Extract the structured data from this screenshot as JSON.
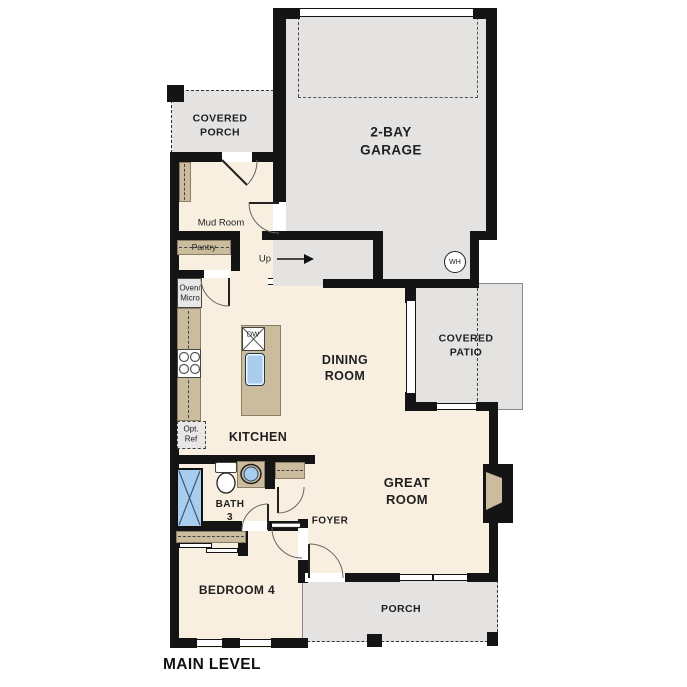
{
  "plan": {
    "title": "MAIN LEVEL"
  },
  "colors": {
    "wall": "#141414",
    "exterior_gray": "#e4e3e1",
    "interior_cream": "#f8efe1",
    "casework_tan": "#cbbc9e",
    "fixture_blue": "#a9cdec"
  },
  "rooms": {
    "garage": {
      "line1": "2-BAY",
      "line2": "GARAGE"
    },
    "covered_porch": {
      "line1": "COVERED",
      "line2": "PORCH"
    },
    "covered_patio": {
      "line1": "COVERED",
      "line2": "PATIO"
    },
    "dining": {
      "line1": "DINING",
      "line2": "ROOM"
    },
    "great_room": {
      "line1": "GREAT",
      "line2": "ROOM"
    },
    "bath3": {
      "line1": "BATH",
      "line2": "3"
    },
    "mud_room": {
      "label": "Mud Room"
    },
    "pantry": {
      "label": "Pantry"
    },
    "kitchen": {
      "label": "KITCHEN"
    },
    "foyer": {
      "label": "FOYER"
    },
    "bedroom4": {
      "label": "BEDROOM 4"
    },
    "porch": {
      "label": "PORCH"
    }
  },
  "annotations": {
    "up": "Up",
    "water_heater": "WH",
    "dishwasher": "DW",
    "oven_line1": "Oven/",
    "oven_line2": "Micro",
    "ref_line1": "Opt.",
    "ref_line2": "Ref"
  }
}
